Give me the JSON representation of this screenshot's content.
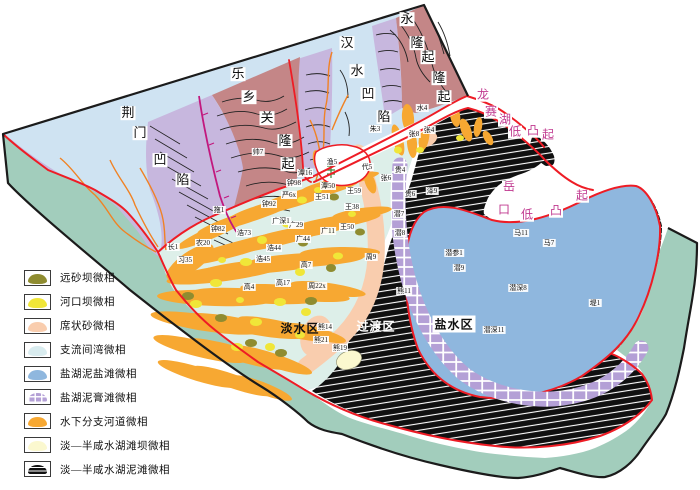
{
  "legend": {
    "items": [
      {
        "id": "distal-bar",
        "label": "远砂坝微相",
        "color": "#8f8c30",
        "pattern": null
      },
      {
        "id": "mouth-bar",
        "label": "河口坝微相",
        "color": "#f0e638",
        "pattern": null
      },
      {
        "id": "sheet-sand",
        "label": "席状砂微相",
        "color": "#f9cdae",
        "pattern": null
      },
      {
        "id": "interdistributary-bay",
        "label": "支流间湾微相",
        "color": "#d9ecef",
        "pattern": null
      },
      {
        "id": "salt-lake-mud-salt-flat",
        "label": "盐湖泥盐滩微相",
        "color": "#8fb7de",
        "pattern": null
      },
      {
        "id": "salt-lake-mud-gypsum-flat",
        "label": "盐湖泥膏滩微相",
        "color": "#b4a0d6",
        "pattern": "grid"
      },
      {
        "id": "subaqueous-distributary-channel",
        "label": "水下分支河道微相",
        "color": "#f7a832",
        "pattern": null
      },
      {
        "id": "fresh-brackish-beach-bar",
        "label": "淡—半咸水湖滩坝微相",
        "color": "#fbf8cf",
        "pattern": null
      },
      {
        "id": "fresh-brackish-mud-flat",
        "label": "淡—半咸水湖泥滩微相",
        "color": "#101010",
        "pattern": "hatch"
      }
    ]
  },
  "map_labels": {
    "structures": [
      {
        "id": "jingmen-depression",
        "color": "dark",
        "chars": [
          {
            "ch": "荆",
            "x": 128,
            "y": 113
          },
          {
            "ch": "门",
            "x": 140,
            "y": 133
          },
          {
            "ch": "凹",
            "x": 160,
            "y": 160
          },
          {
            "ch": "陷",
            "x": 183,
            "y": 180
          }
        ]
      },
      {
        "id": "lexiangguan-uplift",
        "color": "dark",
        "chars": [
          {
            "ch": "乐",
            "x": 238,
            "y": 74
          },
          {
            "ch": "乡",
            "x": 249,
            "y": 97
          },
          {
            "ch": "关",
            "x": 267,
            "y": 118
          },
          {
            "ch": "隆",
            "x": 285,
            "y": 141
          },
          {
            "ch": "起",
            "x": 288,
            "y": 164
          }
        ]
      },
      {
        "id": "hanshui-depression",
        "color": "dark",
        "chars": [
          {
            "ch": "汉",
            "x": 347,
            "y": 43
          },
          {
            "ch": "水",
            "x": 357,
            "y": 71
          },
          {
            "ch": "凹",
            "x": 368,
            "y": 94
          },
          {
            "ch": "陷",
            "x": 384,
            "y": 117
          }
        ]
      },
      {
        "id": "yonglong-uplift",
        "color": "dark",
        "chars": [
          {
            "ch": "永",
            "x": 407,
            "y": 19
          },
          {
            "ch": "隆",
            "x": 417,
            "y": 43
          },
          {
            "ch": "起",
            "x": 428,
            "y": 57
          },
          {
            "ch": "隆",
            "x": 439,
            "y": 78
          },
          {
            "ch": "起",
            "x": 444,
            "y": 97
          }
        ]
      },
      {
        "id": "longsaihu-low-uplift",
        "color": "magenta",
        "chars": [
          {
            "ch": "龙",
            "x": 483,
            "y": 95
          },
          {
            "ch": "赛",
            "x": 491,
            "y": 112
          },
          {
            "ch": "湖",
            "x": 505,
            "y": 120
          },
          {
            "ch": "低",
            "x": 515,
            "y": 132
          },
          {
            "ch": "凸",
            "x": 533,
            "y": 131
          },
          {
            "ch": "起",
            "x": 548,
            "y": 135
          }
        ]
      },
      {
        "id": "yuekou-low-uplift",
        "color": "magenta",
        "chars": [
          {
            "ch": "岳",
            "x": 509,
            "y": 187
          },
          {
            "ch": "口",
            "x": 504,
            "y": 210
          },
          {
            "ch": "低",
            "x": 527,
            "y": 215
          },
          {
            "ch": "凸",
            "x": 556,
            "y": 211
          },
          {
            "ch": "起",
            "x": 582,
            "y": 196
          }
        ]
      }
    ],
    "zones": [
      {
        "id": "fresh-water-zone",
        "text": "淡水区",
        "x": 300,
        "y": 328,
        "style": "dark"
      },
      {
        "id": "transition-zone",
        "text": "过渡区",
        "x": 376,
        "y": 326,
        "style": "light"
      },
      {
        "id": "salt-water-zone",
        "text": "盐水区",
        "x": 454,
        "y": 324,
        "style": "boxed"
      }
    ],
    "wells": [
      {
        "n": "拖1",
        "x": 219,
        "y": 210
      },
      {
        "n": "钟82",
        "x": 218,
        "y": 229
      },
      {
        "n": "农20",
        "x": 203,
        "y": 243
      },
      {
        "n": "长1",
        "x": 173,
        "y": 247
      },
      {
        "n": "习35",
        "x": 185,
        "y": 260
      },
      {
        "n": "浩73",
        "x": 244,
        "y": 233
      },
      {
        "n": "浩44",
        "x": 274,
        "y": 248
      },
      {
        "n": "浩45",
        "x": 263,
        "y": 259
      },
      {
        "n": "高4",
        "x": 249,
        "y": 287
      },
      {
        "n": "高17",
        "x": 283,
        "y": 283
      },
      {
        "n": "高7",
        "x": 306,
        "y": 265
      },
      {
        "n": "周22x",
        "x": 317,
        "y": 286
      },
      {
        "n": "周9",
        "x": 371,
        "y": 257
      },
      {
        "n": "钟92",
        "x": 269,
        "y": 204
      },
      {
        "n": "钟98",
        "x": 294,
        "y": 183
      },
      {
        "n": "严6x",
        "x": 289,
        "y": 195
      },
      {
        "n": "潭16",
        "x": 305,
        "y": 173
      },
      {
        "n": "潭50",
        "x": 328,
        "y": 186
      },
      {
        "n": "王51",
        "x": 322,
        "y": 197
      },
      {
        "n": "王59",
        "x": 354,
        "y": 191
      },
      {
        "n": "王38",
        "x": 352,
        "y": 207
      },
      {
        "n": "王50",
        "x": 347,
        "y": 227
      },
      {
        "n": "广11",
        "x": 328,
        "y": 231
      },
      {
        "n": "广29",
        "x": 296,
        "y": 225
      },
      {
        "n": "广深1",
        "x": 281,
        "y": 221
      },
      {
        "n": "广44",
        "x": 303,
        "y": 239
      },
      {
        "n": "渔5",
        "x": 332,
        "y": 162
      },
      {
        "n": "代5",
        "x": 367,
        "y": 167
      },
      {
        "n": "朱3",
        "x": 375,
        "y": 129
      },
      {
        "n": "水4",
        "x": 422,
        "y": 108
      },
      {
        "n": "张8",
        "x": 414,
        "y": 134
      },
      {
        "n": "张4",
        "x": 429,
        "y": 130
      },
      {
        "n": "贵4",
        "x": 400,
        "y": 170
      },
      {
        "n": "张6",
        "x": 386,
        "y": 178
      },
      {
        "n": "贵6",
        "x": 410,
        "y": 194
      },
      {
        "n": "泽9",
        "x": 432,
        "y": 191
      },
      {
        "n": "潜7",
        "x": 399,
        "y": 214
      },
      {
        "n": "潜8",
        "x": 400,
        "y": 233
      },
      {
        "n": "马11",
        "x": 521,
        "y": 233
      },
      {
        "n": "马7",
        "x": 549,
        "y": 243
      },
      {
        "n": "潜参1",
        "x": 454,
        "y": 253
      },
      {
        "n": "潜9",
        "x": 459,
        "y": 268
      },
      {
        "n": "潜深8",
        "x": 518,
        "y": 288
      },
      {
        "n": "堤1",
        "x": 595,
        "y": 303
      },
      {
        "n": "潜深11",
        "x": 494,
        "y": 330
      },
      {
        "n": "熊14",
        "x": 325,
        "y": 327
      },
      {
        "n": "熊21",
        "x": 321,
        "y": 340
      },
      {
        "n": "熊19",
        "x": 340,
        "y": 348
      },
      {
        "n": "熊11",
        "x": 404,
        "y": 291
      },
      {
        "n": "帅7",
        "x": 258,
        "y": 152
      }
    ]
  },
  "colors": {
    "teal": "#a2cdbc",
    "light_blue": "#cfe3f2",
    "lavender": "#c7b7de",
    "brown": "#c48687",
    "delta": "#ddefe9",
    "orange": "#f7a832",
    "yellow": "#f0e638",
    "olive": "#8f8c30",
    "pink": "#f9cdae",
    "cream": "#fbf8cf",
    "salt_blue": "#8fb7de",
    "gypsum_purple": "#b4a0d6",
    "mudflat_black": "#101010",
    "red_line": "#ee1c25",
    "fault_magenta": "#c2187e",
    "river_orange": "#f08224",
    "magenta_text": "#c0388f",
    "outline": "#1b1b1b",
    "contour": "#222222",
    "mine_green": "#3a8a3a"
  }
}
